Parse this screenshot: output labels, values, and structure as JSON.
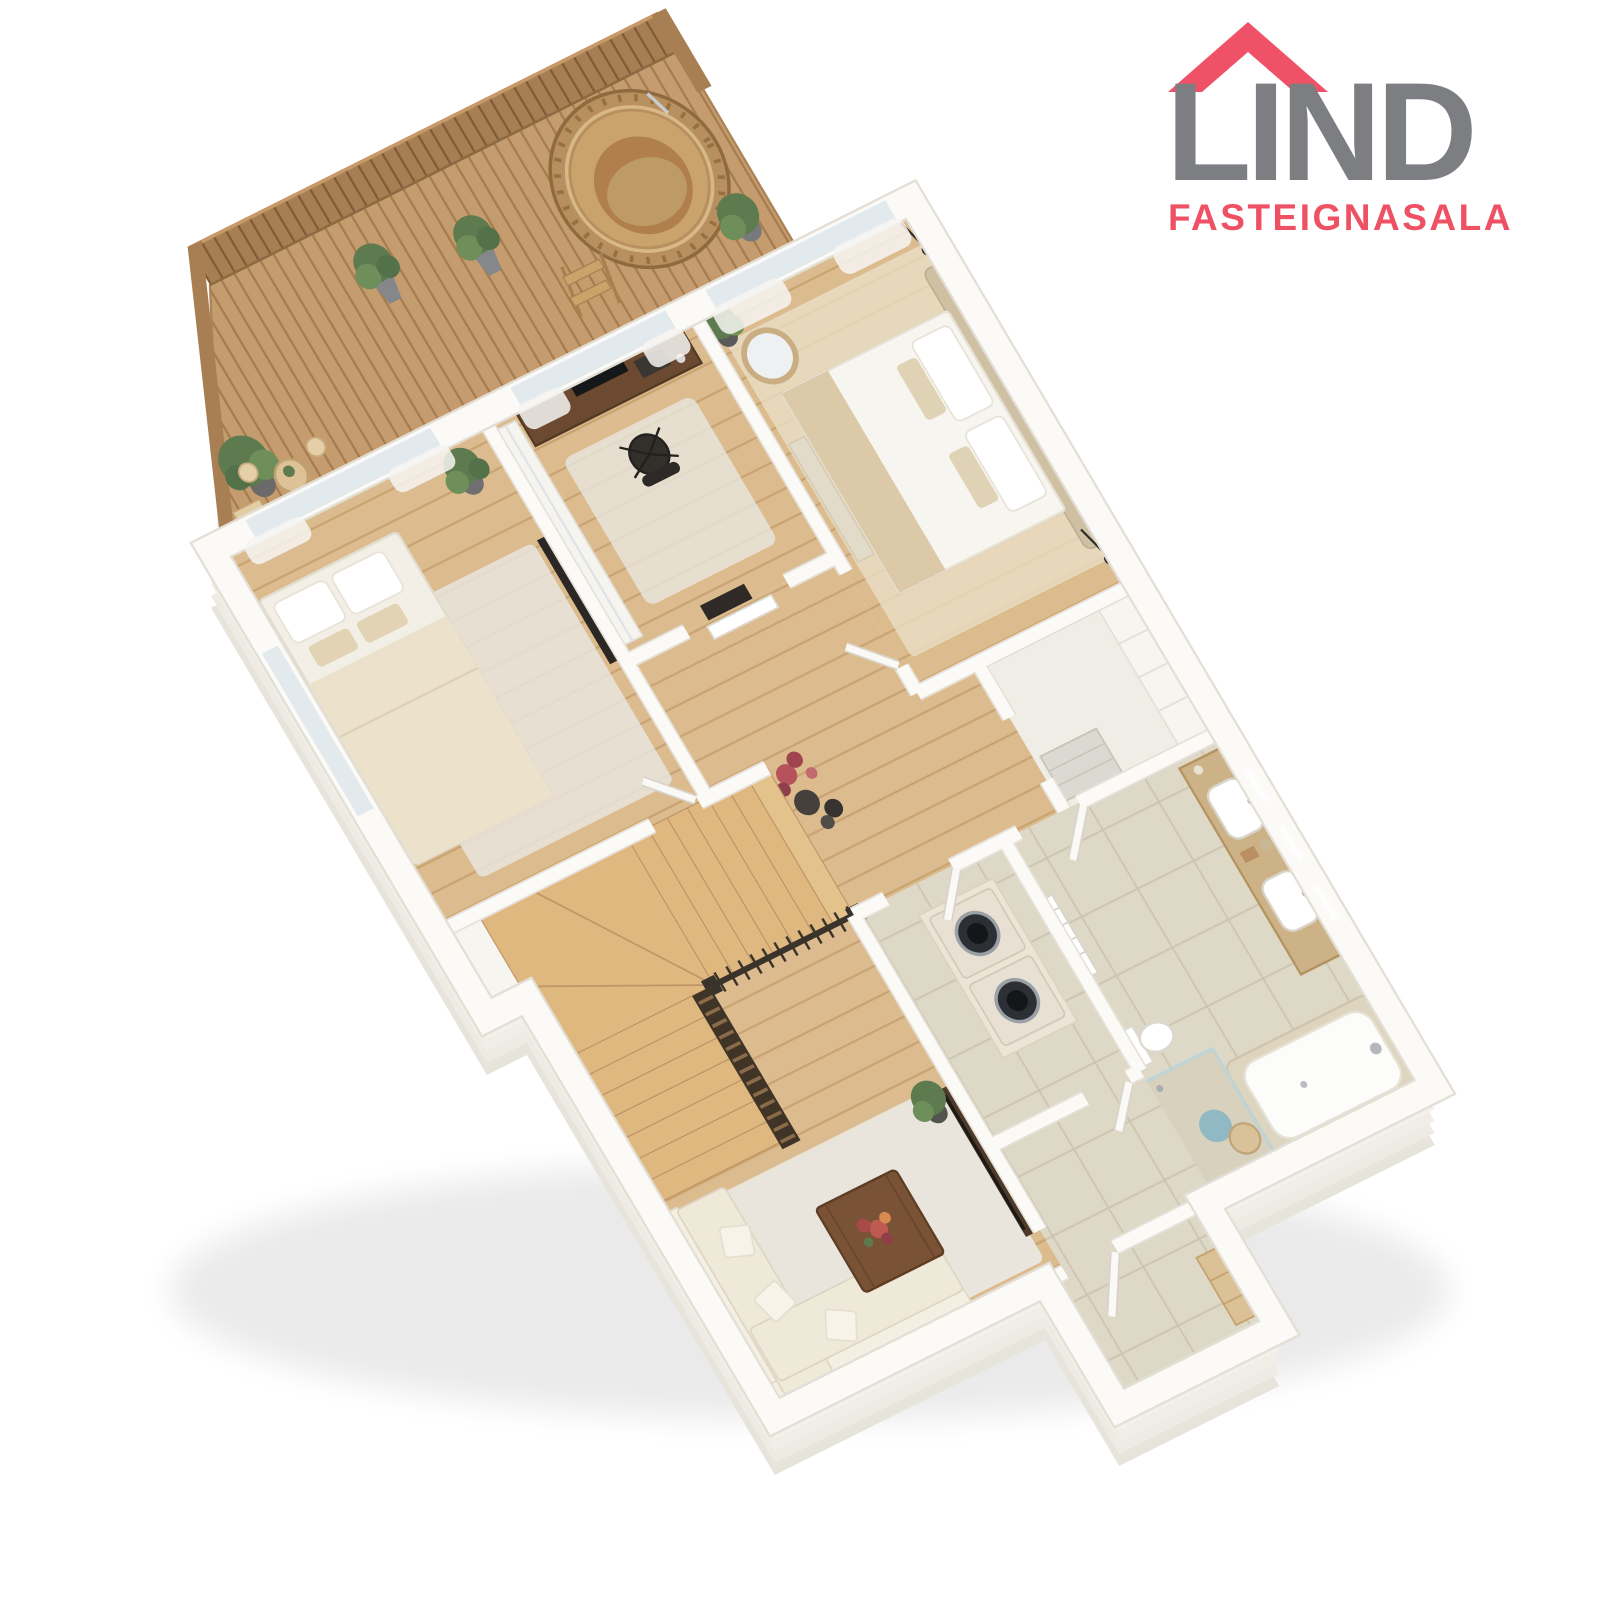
{
  "canvas": {
    "width": 1600,
    "height": 1600,
    "background": "#ffffff"
  },
  "logo": {
    "title": "LIND",
    "subtitle": "FASTEIGNASALA",
    "roof_color": "#ef5166",
    "title_color": "#7c7e81",
    "subtitle_color": "#ef5164"
  },
  "scene": {
    "type": "isometric-3d-floor-plan-render",
    "palette": {
      "wall_top": "#fbfaf7",
      "wall_rim": "#e3dfd6",
      "slab_side": "#f1eee8",
      "wood_floor": "#dcbc8f",
      "deck_wood": "#c59c6e",
      "fence_wood": "#a87f52",
      "tile": "#ded8c7",
      "stair_wood": "#deb87f",
      "railing_dark": "#3a332c",
      "walnut": "#6b4a31",
      "textile_cream": "#efe9da",
      "accent_foliage_red": "#b5525c",
      "plant_green": "#5d7b4e"
    },
    "rooms": [
      "roof-terrace",
      "bedroom-1",
      "home-office",
      "master-bedroom",
      "walk-in-closet",
      "bathroom",
      "laundry-room",
      "hallway-with-stairs",
      "living-room",
      "entrance-vestibule"
    ],
    "features": [
      "wooden-hot-tub",
      "privacy-fence",
      "potted-plants",
      "bistro-set",
      "u-shaped-staircase",
      "slatted-wood-screen",
      "washer-dryer",
      "bathtub",
      "walk-in-shower",
      "double-vanity",
      "towel-radiator",
      "sectional-sofa",
      "coffee-table-with-flowers",
      "wall-mounted-tv",
      "desk-with-office-chair",
      "double-beds",
      "decor-vases"
    ]
  }
}
